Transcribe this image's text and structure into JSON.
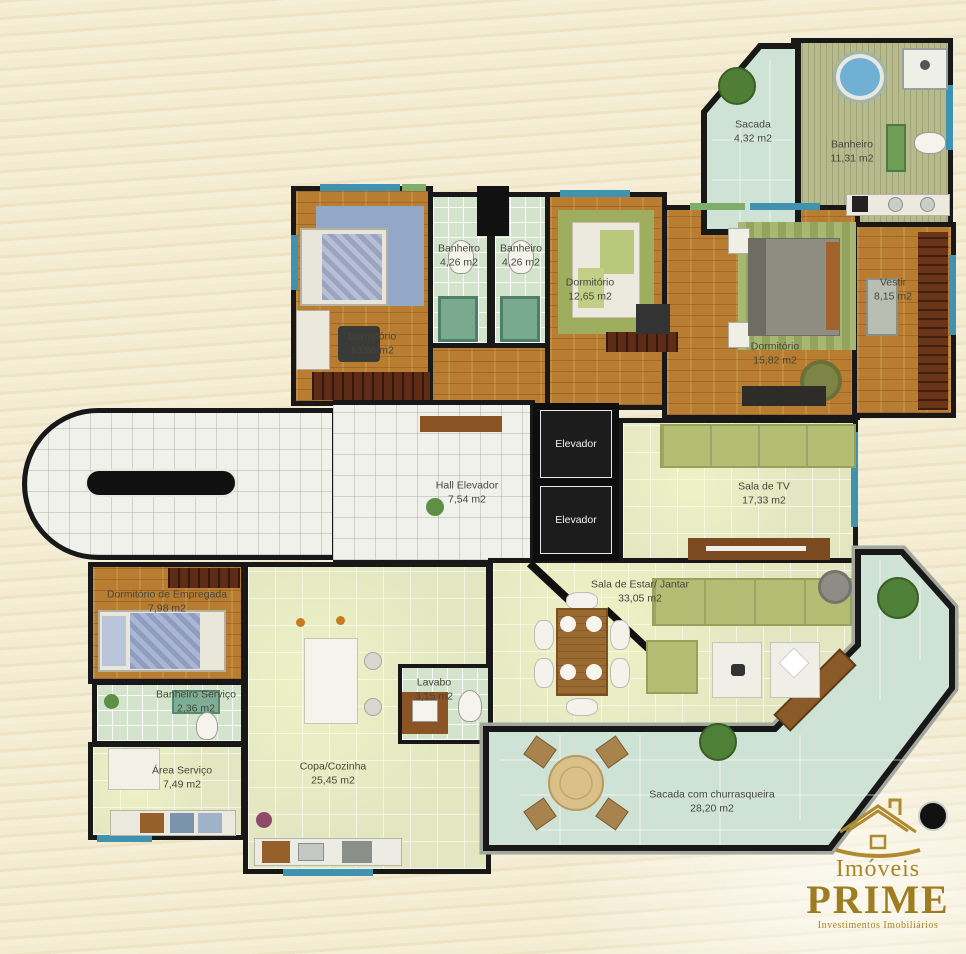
{
  "plan_title": "Apartment floor plan",
  "rooms": [
    {
      "name": "Sacada",
      "area": "4,32 m2"
    },
    {
      "name": "Banheiro",
      "area": "11,31 m2"
    },
    {
      "name": "Dormitório",
      "area": "13,96 m2"
    },
    {
      "name": "Banheiro",
      "area": "4,26 m2"
    },
    {
      "name": "Banheiro",
      "area": "4,26 m2"
    },
    {
      "name": "Dormitório",
      "area": "12,65 m2"
    },
    {
      "name": "Dormitório",
      "area": "15,82 m2"
    },
    {
      "name": "Vestir",
      "area": "8,15 m2"
    },
    {
      "name": "Hall Elevador",
      "area": "7,54 m2"
    },
    {
      "name": "Elevador",
      "area": ""
    },
    {
      "name": "Elevador",
      "area": ""
    },
    {
      "name": "Sala de TV",
      "area": "17,33 m2"
    },
    {
      "name": "Sala de Estar/ Jantar",
      "area": "33,05 m2"
    },
    {
      "name": "Dormitório de Empregada",
      "area": "7,98 m2"
    },
    {
      "name": "Banheiro Serviço",
      "area": "2,36 m2"
    },
    {
      "name": "Área Serviço",
      "area": "7,49 m2"
    },
    {
      "name": "Copa/Cozinha",
      "area": "25,45 m2"
    },
    {
      "name": "Lavabo",
      "area": "3,15 m2"
    },
    {
      "name": "Sacada com churrasqueira",
      "area": "28,20 m2"
    }
  ],
  "logo": {
    "line1": "Imóveis",
    "line2": "PRIME",
    "line3": "Investimentos Imobiliários"
  },
  "palette": {
    "background": "#f3ecd2",
    "wall": "#181818",
    "wood_floor": "#b87d31",
    "bath_tile": "#d4e3cc",
    "living_tile": "#e2e7c2",
    "white_tile": "#f0f1ea",
    "balcony_tile": "#cfe2d6",
    "olive_tile": "#b6ba8c",
    "logo_gold": "#a9862c"
  }
}
